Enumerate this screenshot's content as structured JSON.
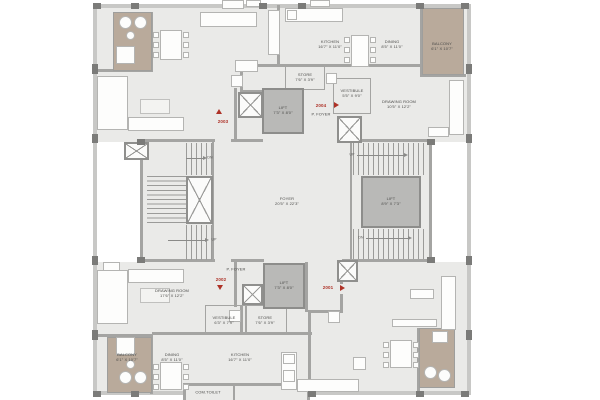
{
  "colors": {
    "floor": "#eaeae8",
    "wall": "#a4a4a2",
    "outer_wall": "#c8c8c6",
    "column": "#7b7b79",
    "balcony": "#b9aa9b",
    "lift": "#b9b9b7",
    "accent_red": "#ae3227",
    "text": "#4a4a48"
  },
  "rooms": {
    "kitchen_tr": {
      "name": "KITCHEN",
      "dims": "16'7\" X 11'0\""
    },
    "dining_tr": {
      "name": "DINING",
      "dims": "8'5\" X 11'0\""
    },
    "balcony_tr": {
      "name": "BALCONY",
      "dims": "6'1\" X 10'7\""
    },
    "store_tr": {
      "name": "STORE",
      "dims": "7'6\" X 3'9\""
    },
    "vestibule_tr": {
      "name": "VESTIBULE",
      "dims": "5'5\" X 9'0\""
    },
    "drawing_tr": {
      "name": "DRAWING ROOM",
      "dims": "10'5\" X 12'2\""
    },
    "lift_top": {
      "name": "LIFT",
      "dims": "7'3\" X 8'0\""
    },
    "pfoyer_top": {
      "name": "P. FOYER"
    },
    "foyer": {
      "name": "FOYER",
      "dims": "20'5\" X 22'3\""
    },
    "lift_right": {
      "name": "LIFT",
      "dims": "8'9\" X 7'3\""
    },
    "lift_bottom": {
      "name": "LIFT",
      "dims": "7'3\" X 8'0\""
    },
    "pfoyer_bottom": {
      "name": "P. FOYER"
    },
    "drawing_bl": {
      "name": "DRAWING ROOM",
      "dims": "17'6\" X 12'2\""
    },
    "vestibule_bl": {
      "name": "VESTIBULE",
      "dims": "6'3\" X 7'9\""
    },
    "store_bl": {
      "name": "STORE",
      "dims": "7'6\" X 3'9\""
    },
    "balcony_bl": {
      "name": "BALCONY",
      "dims": "6'1\" X 10'7\""
    },
    "dining_bl": {
      "name": "DINING",
      "dims": "8'5\" X 11'0\""
    },
    "kitchen_bl": {
      "name": "KITCHEN",
      "dims": "16'7\" X 11'0\""
    },
    "com_toilet": {
      "name": "COM.TOILET"
    }
  },
  "unit_numbers": {
    "u2001": "2001",
    "u2002": "2002",
    "u2003": "2003",
    "u2004": "2004"
  },
  "stair_labels": {
    "up": "UP",
    "dn": "DN"
  }
}
